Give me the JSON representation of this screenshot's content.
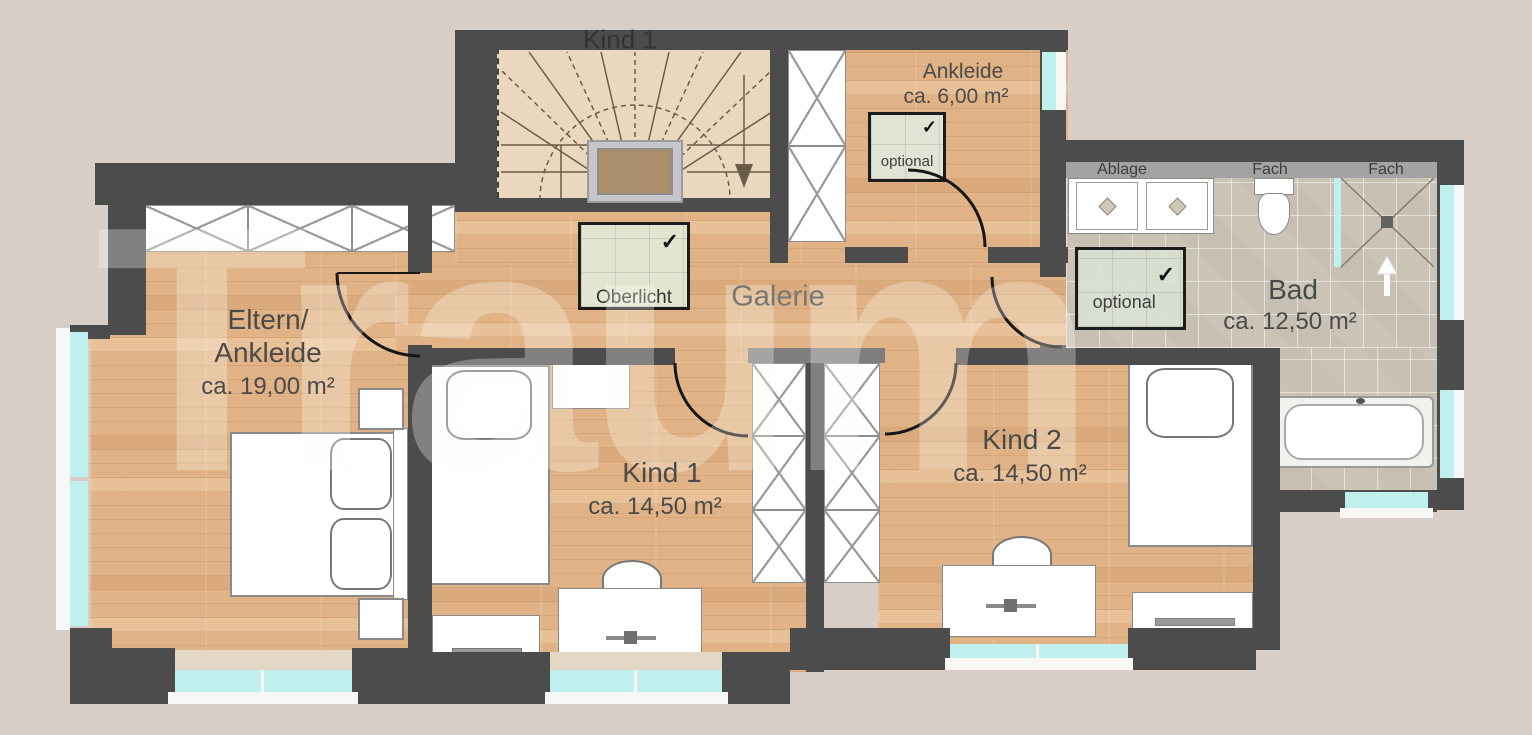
{
  "watermark": "Traum",
  "rooms": {
    "eltern": {
      "name1": "Eltern/",
      "name2": "Ankleide",
      "area": "ca. 19,00 m²"
    },
    "kind1": {
      "name": "Kind 1",
      "area": "ca. 14,50 m²"
    },
    "kind2": {
      "name": "Kind 2",
      "area": "ca. 14,50 m²"
    },
    "bad": {
      "name": "Bad",
      "area": "ca. 12,50 m²"
    },
    "galerie": {
      "name": "Galerie"
    },
    "ankleide": {
      "name": "Ankleide",
      "area": "ca. 6,00 m²"
    },
    "stairwell_hidden_label": "Kind 1"
  },
  "annotations": {
    "oberlicht": {
      "label": "Oberlicht",
      "check": "✓"
    },
    "optional_ankleide": {
      "label": "optional",
      "check": "✓"
    },
    "optional_bad": {
      "label": "optional",
      "check": "✓"
    }
  },
  "bath": {
    "ablage": "Ablage",
    "fach_left": "Fach",
    "fach_right": "Fach"
  },
  "colors": {
    "wall": "#4c4c4c",
    "wood_floor": "#e0b285",
    "tile_floor": "#cbc4b6",
    "window_glass": "#bff0ee",
    "annotation_box": "#dce4d2",
    "background": "#d7cfc7"
  }
}
